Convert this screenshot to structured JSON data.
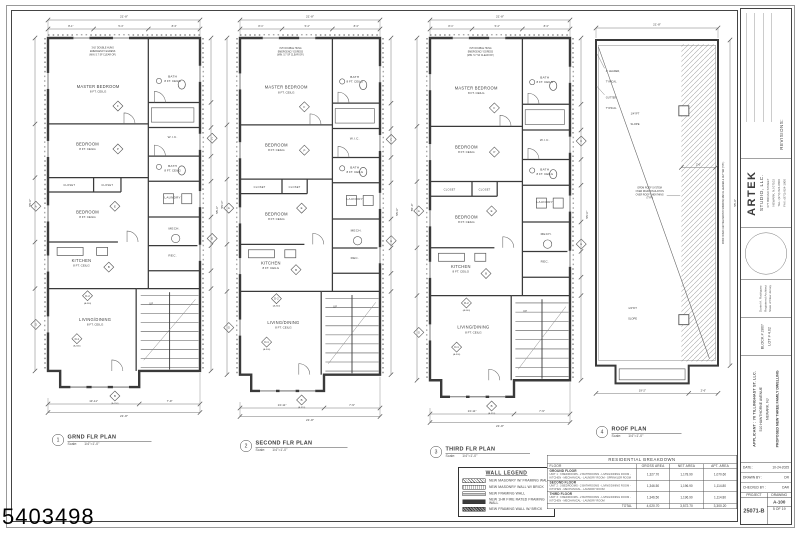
{
  "sheet": {
    "watermark": "5403498",
    "colors": {
      "line": "#3a3a3a",
      "paper": "#ffffff",
      "dim": "#777777"
    }
  },
  "plans": [
    {
      "num": "1",
      "title": "GRND FLR PLAN",
      "scale_label": "Scale:",
      "scale": "1/4\"=1'-0\"",
      "kind": "floor"
    },
    {
      "num": "2",
      "title": "SECOND FLR PLAN",
      "scale_label": "Scale:",
      "scale": "1/4\"=1'-0\"",
      "kind": "floor"
    },
    {
      "num": "3",
      "title": "THIRD FLR PLAN",
      "scale_label": "Scale:",
      "scale": "1/4\"=1'-0\"",
      "kind": "floor"
    },
    {
      "num": "4",
      "title": "ROOF PLAN",
      "scale_label": "Scale:",
      "scale": "1/4\"=1'-0\"",
      "kind": "roof"
    }
  ],
  "floor_layout": {
    "rooms": [
      {
        "label": "MASTER BEDROOM",
        "sub": "8 FT. CEILG",
        "x": 33,
        "y": 14,
        "s": 4.1
      },
      {
        "label": "BATH",
        "sub": "8 FT. CEILG",
        "x": 82,
        "y": 11,
        "s": 3.1
      },
      {
        "label": "W.I.C.",
        "sub": "",
        "x": 82,
        "y": 28,
        "s": 3.1
      },
      {
        "label": "BEDROOM",
        "sub": "8 FT. CEILG",
        "x": 26,
        "y": 30,
        "s": 4.1
      },
      {
        "label": "BATH",
        "sub": "8 FT. CEILG",
        "x": 82,
        "y": 36,
        "s": 3.1
      },
      {
        "label": "CLOSET",
        "sub": "",
        "x": 14,
        "y": 41.4,
        "s": 2.6
      },
      {
        "label": "CLOSET",
        "sub": "",
        "x": 39,
        "y": 41.4,
        "s": 2.6
      },
      {
        "label": "LAUNDRY",
        "sub": "",
        "x": 82,
        "y": 44.8,
        "s": 3.1
      },
      {
        "label": "BEDROOM",
        "sub": "8 FT. CEILG",
        "x": 26,
        "y": 49,
        "s": 4.1
      },
      {
        "label": "MECH.",
        "sub": "",
        "x": 83,
        "y": 53.5,
        "s": 3.1
      },
      {
        "label": "REC.",
        "sub": "",
        "x": 82,
        "y": 61,
        "s": 3.1
      },
      {
        "label": "KITCHEN",
        "sub": "8 FT. CEILG",
        "x": 22,
        "y": 62.5,
        "s": 4.1
      },
      {
        "label": "LIVING/DINING",
        "sub": "8 FT. CEILG",
        "x": 31,
        "y": 79,
        "s": 4.1
      },
      {
        "label": "UP",
        "sub": "",
        "x": 68,
        "y": 74.5,
        "s": 2.6
      }
    ],
    "egress_note": [
      "3'x5' DOUBLE HUNG",
      "EMERGENCY EGRESS",
      "(MIN. 5.7 SF CLEAR OP.)"
    ],
    "tags": [
      {
        "t": "F",
        "x": 46,
        "y": 19,
        "sub": ""
      },
      {
        "t": "P",
        "x": 46,
        "y": 31,
        "sub": ""
      },
      {
        "t": "E",
        "x": 44,
        "y": 47,
        "sub": ""
      },
      {
        "t": "B",
        "x": 40,
        "y": 64,
        "sub": ""
      },
      {
        "t": "A",
        "x": -8,
        "y": 47,
        "sub": ""
      },
      {
        "t": "G",
        "x": -8,
        "y": 80,
        "sub": ""
      },
      {
        "t": "C",
        "x": 108,
        "y": 28,
        "sub": ""
      },
      {
        "t": "E",
        "x": 108,
        "y": 56,
        "sub": ""
      },
      {
        "t": "D-2",
        "x": 26,
        "y": 72,
        "sub": "(A-300)"
      },
      {
        "t": "D-1",
        "x": 19,
        "y": 84,
        "sub": "(A-300)"
      },
      {
        "t": "B",
        "x": 44,
        "y": 100,
        "sub": "(A-310)"
      }
    ],
    "dims": {
      "top": "21'-8\"",
      "top_segs": [
        "8'-1\"",
        "5'-4\"",
        "8'-3\""
      ],
      "left": "55'-0\"",
      "right": "55'-0\"",
      "bottom_a": "13'-11\"",
      "bottom_b": "7'-9\"",
      "bottom_total": "21'-8\""
    }
  },
  "roof_layout": {
    "labels": {
      "leader": "4\" LEADER,",
      "leader2": "TYPICAL",
      "gutter": "GUTTER,",
      "gutter2": "TYPICAL",
      "slope": "1/4\"/FT",
      "slope_sub": "SLOPE",
      "note": [
        "EPDM ROOF SYSTEM",
        "OVER RIGID INSULATION",
        "OVER ROOF SHEATHING",
        "(TYP.)"
      ],
      "side": "ROOF OVER CANTILEVER BAY WINDOW, METAL LEADER & GUTTER (TYP.)",
      "offset_dim": "2'-6\""
    },
    "dims": {
      "top": "21'-8\"",
      "right": "55'-0\"",
      "bottom_a": "19'-2\"",
      "bottom_b": "2'-6\""
    }
  },
  "legend": {
    "title": "WALL LEGEND",
    "items": [
      {
        "swatch": "hatch",
        "label": "NEW MASONRY W/ FRAMING WALL"
      },
      {
        "swatch": "brick",
        "label": "NEW MASONRY WALL W/ BRICK"
      },
      {
        "swatch": "frame",
        "label": "NEW FRAMING WALL"
      },
      {
        "swatch": "fire",
        "label": "NEW 1HR FIRE RATED FRAMING WALL"
      },
      {
        "swatch": "brickframe",
        "label": "NEW FRAMING WALL W/ BRICK"
      }
    ]
  },
  "breakdown": {
    "title": "RESIDENTIAL BREAKDOWN",
    "columns": [
      "FLOOR",
      "GROSS AREA",
      "NET AREA",
      "APT. AREA"
    ],
    "rows": [
      {
        "floor": "GROUND FLOOR",
        "desc": "UNIT 1 : 3 BEDROOMS - 2 BATHROOMS - LIVING/DINING ROOM - KITCHEN - MECHANICAL - LAUNDRY ROOM - SPRINKLER ROOM",
        "gross": "1,327.70",
        "net": "1,178.90",
        "apt": "1,070.60"
      },
      {
        "floor": "SECOND FLOOR",
        "desc": "UNIT 2 : 3 BEDROOMS - 2 BATHROOMS - LIVING/DINING ROOM - KITCHEN - MECHANICAL - LAUNDRY ROOM",
        "gross": "1,346.50",
        "net": "1,196.90",
        "apt": "1,114.80"
      },
      {
        "floor": "THIRD FLOOR",
        "desc": "UNIT 3 : 3 BEDROOMS - 2 BATHROOMS - LIVING/DINING ROOM - KITCHEN - MECHANICAL - LAUNDRY ROOM",
        "gross": "1,346.50",
        "net": "1,196.90",
        "apt": "1,114.80"
      }
    ],
    "total": {
      "label": "TOTAL",
      "gross": "4,020.70",
      "net": "3,572.70",
      "apt": "3,300.20"
    }
  },
  "titleblock": {
    "revisions_label": "REVISIONS:",
    "firm": {
      "name": "ARTEK",
      "name2": "STUDIO, LLC.",
      "addr": [
        "677 BROAD STREET",
        "NEWARK, NJ 07102",
        "TEL: (973) 824-0800",
        "FAX: (973) 824-1900"
      ]
    },
    "architect": [
      "Daniel A. Rodriguez",
      "Registered Architect",
      "State of New Jersey"
    ],
    "blocklot": [
      "BLOCK # 2807",
      "LOT # 4.02"
    ],
    "applicant": {
      "line1": "APPLICANT : 70 TILLINGHAST ST. LLC.",
      "line2": "510 HAWTHORNE AVENUE",
      "line3": "NEWARK, NJ",
      "line4": "PROPOSED NEW THREE FAMILY DWELLING"
    },
    "meta": [
      {
        "label": "DATE :",
        "value": "10-24-2025"
      },
      {
        "label": "DRAWN BY :",
        "value": "DR"
      },
      {
        "label": "CHECKED BY :",
        "value": "DAR"
      }
    ],
    "project": {
      "header": "PROJECT",
      "number": "25071-B"
    },
    "drawing": {
      "header": "DRAWING",
      "number": "A-100",
      "sheet": "5 OF 19"
    }
  }
}
